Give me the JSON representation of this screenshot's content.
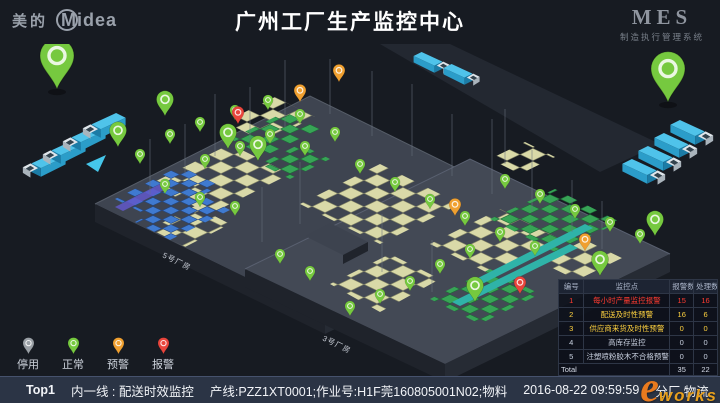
{
  "header": {
    "brand_cn": "美的",
    "brand_en": "Midea",
    "title": "广州工厂生产监控中心",
    "mes": "MES",
    "mes_subtitle": "制造执行管理系统"
  },
  "scene": {
    "building_label_left": "5号厂房",
    "building_label_right": "3号厂房"
  },
  "legend": {
    "items": [
      {
        "label": "停用",
        "status": "disabled"
      },
      {
        "label": "正常",
        "status": "normal"
      },
      {
        "label": "预警",
        "status": "warning"
      },
      {
        "label": "报警",
        "status": "alarm"
      }
    ]
  },
  "monitor_table": {
    "headers": [
      "编号",
      "监控点",
      "报警数",
      "处理数"
    ],
    "rows": [
      {
        "no": "1",
        "name": "每小时产量监控报警",
        "alarms": "15",
        "handled": "16",
        "severity": "alarm"
      },
      {
        "no": "2",
        "name": "配送及时性预警",
        "alarms": "16",
        "handled": "6",
        "severity": "warning"
      },
      {
        "no": "3",
        "name": "供应商来货及时性预警",
        "alarms": "0",
        "handled": "0",
        "severity": "warning"
      },
      {
        "no": "4",
        "name": "高库存监控",
        "alarms": "0",
        "handled": "0",
        "severity": "normal"
      },
      {
        "no": "5",
        "name": "注塑喷粉胶木不合格预警",
        "alarms": "0",
        "handled": "0",
        "severity": "normal"
      }
    ],
    "total_label": "Total",
    "total_alarms": "35",
    "total_handled": "22"
  },
  "ticker": {
    "rank": "Top1",
    "line": "内一线 : 配送时效监控",
    "detail": "产线:PZZ1XT0001;作业号:H1F莞160805001N02;物料",
    "timestamp": "2016-08-22 09:59:59",
    "nav_logistics": "分厂 物流",
    "nav_warehouse": "分厂 仓管"
  },
  "watermark": {
    "e": "e",
    "rest": "works"
  },
  "colors": {
    "bg": "#171b22",
    "bar": "#2b3445",
    "normal": "#76c93f",
    "warning": "#f0a030",
    "alarm": "#e8453c",
    "disabled": "#9aa0a6",
    "red": "#ff3b30",
    "yellow": "#ffd23f",
    "wm": "#e87a1e",
    "floor": "#3e4450",
    "pallet": "#d9d9a8",
    "truck": "#4fc3ea"
  }
}
